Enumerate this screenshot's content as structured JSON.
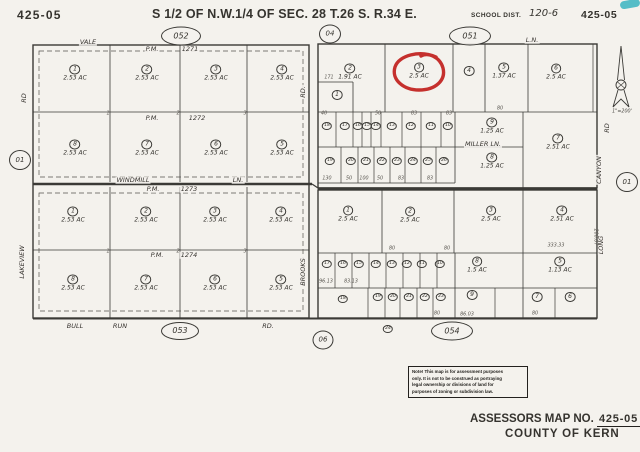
{
  "header": {
    "map_no_left": "425-05",
    "title": "S 1/2 OF N.W.1/4 OF SEC. 28 T.26 S. R.34 E.",
    "school_dist_label": "SCHOOL DIST.",
    "school_dist_value": "120-6",
    "map_no_right": "425-05"
  },
  "map": {
    "colors": {
      "red_annotation": "#c5302d",
      "teal_artifact": "#38b4c0",
      "ink": "#3b3a36"
    },
    "north_arrow": {
      "scale_text": "1\"=200'"
    },
    "red_annotation": {
      "around": "parcel 3 (2.5 AC), right-top block"
    },
    "ref_circles": [
      {
        "label": "052",
        "x": 181,
        "y": 36,
        "w": 38,
        "h": 17
      },
      {
        "label": "04",
        "x": 330,
        "y": 34,
        "w": 20,
        "h": 17
      },
      {
        "label": "051",
        "x": 470,
        "y": 36,
        "w": 40,
        "h": 17
      },
      {
        "label": "01",
        "x": 20,
        "y": 160,
        "w": 20,
        "h": 18
      },
      {
        "label": "01",
        "x": 627,
        "y": 182,
        "w": 20,
        "h": 18
      },
      {
        "label": "053",
        "x": 180,
        "y": 331,
        "w": 36,
        "h": 16
      },
      {
        "label": "06",
        "x": 323,
        "y": 340,
        "w": 19,
        "h": 17
      },
      {
        "label": "054",
        "x": 452,
        "y": 331,
        "w": 40,
        "h": 17
      }
    ],
    "street_labels": [
      {
        "t": "VALE",
        "x": 88,
        "y": 42
      },
      {
        "t": "P.M.",
        "x": 152,
        "y": 49
      },
      {
        "t": "1271",
        "x": 190,
        "y": 49
      },
      {
        "t": "P.M.",
        "x": 152,
        "y": 118
      },
      {
        "t": "1272",
        "x": 197,
        "y": 118
      },
      {
        "t": "WINDMILL",
        "x": 133,
        "y": 180
      },
      {
        "t": "LN.",
        "x": 238,
        "y": 180
      },
      {
        "t": "P.M.",
        "x": 153,
        "y": 189
      },
      {
        "t": "1273",
        "x": 189,
        "y": 189
      },
      {
        "t": "P.M.",
        "x": 157,
        "y": 255
      },
      {
        "t": "1274",
        "x": 189,
        "y": 255
      },
      {
        "t": "BULL",
        "x": 75,
        "y": 326
      },
      {
        "t": "RUN",
        "x": 120,
        "y": 326
      },
      {
        "t": "RD.",
        "x": 268,
        "y": 326
      },
      {
        "t": "MILLER LN.",
        "x": 483,
        "y": 144
      },
      {
        "t": "L.N.",
        "x": 532,
        "y": 40
      },
      {
        "t": "RD",
        "x": 24,
        "y": 98,
        "r": -90
      },
      {
        "t": "LAKEVIEW",
        "x": 22,
        "y": 262,
        "r": -90
      },
      {
        "t": "RD.",
        "x": 303,
        "y": 92,
        "r": -90
      },
      {
        "t": "BROOKS",
        "x": 303,
        "y": 272,
        "r": -90
      },
      {
        "t": "RD",
        "x": 607,
        "y": 128,
        "r": -90
      },
      {
        "t": "CANYON",
        "x": 599,
        "y": 170,
        "r": -90
      },
      {
        "t": "LONG",
        "x": 601,
        "y": 245,
        "r": -90
      }
    ],
    "parcels": [
      {
        "b": "lt",
        "n": "1",
        "ac": "2.53 AC",
        "x": 75,
        "y": 73
      },
      {
        "b": "lt",
        "n": "2",
        "ac": "2.53 AC",
        "x": 147,
        "y": 73
      },
      {
        "b": "lt",
        "n": "3",
        "ac": "2.53 AC",
        "x": 216,
        "y": 73
      },
      {
        "b": "lt",
        "n": "4",
        "ac": "2.53 AC",
        "x": 282,
        "y": 73
      },
      {
        "b": "lt",
        "n": "8",
        "ac": "2.53 AC",
        "x": 75,
        "y": 148
      },
      {
        "b": "lt",
        "n": "7",
        "ac": "2.53 AC",
        "x": 147,
        "y": 148
      },
      {
        "b": "lt",
        "n": "6",
        "ac": "2.53 AC",
        "x": 216,
        "y": 148
      },
      {
        "b": "lt",
        "n": "5",
        "ac": "2.53 AC",
        "x": 282,
        "y": 148
      },
      {
        "b": "lb",
        "n": "1",
        "ac": "2.53 AC",
        "x": 73,
        "y": 215
      },
      {
        "b": "lb",
        "n": "2",
        "ac": "2.53 AC",
        "x": 146,
        "y": 215
      },
      {
        "b": "lb",
        "n": "3",
        "ac": "2.53 AC",
        "x": 215,
        "y": 215
      },
      {
        "b": "lb",
        "n": "4",
        "ac": "2.53 AC",
        "x": 281,
        "y": 215
      },
      {
        "b": "lb",
        "n": "8",
        "ac": "2.53 AC",
        "x": 73,
        "y": 283
      },
      {
        "b": "lb",
        "n": "7",
        "ac": "2.53 AC",
        "x": 146,
        "y": 283
      },
      {
        "b": "lb",
        "n": "6",
        "ac": "2.53 AC",
        "x": 215,
        "y": 283
      },
      {
        "b": "lb",
        "n": "5",
        "ac": "2.53 AC",
        "x": 281,
        "y": 283
      },
      {
        "b": "rt",
        "n": "2",
        "ac": "1.91 AC",
        "x": 350,
        "y": 72
      },
      {
        "b": "rt",
        "n": "1",
        "x": 337,
        "y": 95
      },
      {
        "b": "rt",
        "n": "3",
        "ac": "2.5 AC",
        "x": 419,
        "y": 71
      },
      {
        "b": "rt",
        "n": "4",
        "x": 469,
        "y": 71
      },
      {
        "b": "rt",
        "n": "5",
        "ac": "1.37 AC",
        "x": 504,
        "y": 71
      },
      {
        "b": "rt",
        "n": "6",
        "ac": "2.5 AC",
        "x": 556,
        "y": 72
      },
      {
        "b": "rt",
        "n": "18",
        "s": "t",
        "x": 327,
        "y": 126
      },
      {
        "b": "rt",
        "n": "17",
        "s": "t",
        "x": 345,
        "y": 126
      },
      {
        "b": "rt",
        "n": "16",
        "s": "t",
        "x": 358,
        "y": 126
      },
      {
        "b": "rt",
        "n": "15",
        "s": "t",
        "x": 367,
        "y": 126
      },
      {
        "b": "rt",
        "n": "14",
        "s": "t",
        "x": 376,
        "y": 126
      },
      {
        "b": "rt",
        "n": "13",
        "s": "t",
        "x": 392,
        "y": 126
      },
      {
        "b": "rt",
        "n": "12",
        "s": "t",
        "x": 411,
        "y": 126
      },
      {
        "b": "rt",
        "n": "11",
        "s": "t",
        "x": 431,
        "y": 126
      },
      {
        "b": "rt",
        "n": "10",
        "s": "t",
        "x": 448,
        "y": 126
      },
      {
        "b": "rt",
        "n": "9",
        "ac": "1.25 AC",
        "x": 492,
        "y": 126
      },
      {
        "b": "rt",
        "n": "19",
        "s": "t",
        "x": 330,
        "y": 161
      },
      {
        "b": "rt",
        "n": "20",
        "s": "t",
        "x": 351,
        "y": 161
      },
      {
        "b": "rt",
        "n": "21",
        "s": "t",
        "x": 366,
        "y": 161
      },
      {
        "b": "rt",
        "n": "22",
        "s": "t",
        "x": 382,
        "y": 161
      },
      {
        "b": "rt",
        "n": "23",
        "s": "t",
        "x": 397,
        "y": 161
      },
      {
        "b": "rt",
        "n": "24",
        "s": "t",
        "x": 413,
        "y": 161
      },
      {
        "b": "rt",
        "n": "25",
        "s": "t",
        "x": 428,
        "y": 161
      },
      {
        "b": "rt",
        "n": "26",
        "s": "t",
        "x": 444,
        "y": 161
      },
      {
        "b": "rt",
        "n": "8",
        "ac": "1.25 AC",
        "x": 492,
        "y": 161
      },
      {
        "b": "rt",
        "n": "7",
        "ac": "2.51 AC",
        "x": 558,
        "y": 142
      },
      {
        "b": "rb",
        "n": "1",
        "ac": "2.5 AC",
        "x": 348,
        "y": 214
      },
      {
        "b": "rb",
        "n": "2",
        "ac": "2.5 AC",
        "x": 410,
        "y": 215
      },
      {
        "b": "rb",
        "n": "3",
        "ac": "2.5 AC",
        "x": 491,
        "y": 214
      },
      {
        "b": "rb",
        "n": "4",
        "ac": "2.51 AC",
        "x": 562,
        "y": 214
      },
      {
        "b": "rb",
        "n": "17",
        "s": "t",
        "x": 327,
        "y": 264
      },
      {
        "b": "rb",
        "n": "16",
        "s": "t",
        "x": 343,
        "y": 264
      },
      {
        "b": "rb",
        "n": "15",
        "s": "t",
        "x": 359,
        "y": 264
      },
      {
        "b": "rb",
        "n": "14",
        "s": "t",
        "x": 376,
        "y": 264
      },
      {
        "b": "rb",
        "n": "13",
        "s": "t",
        "x": 392,
        "y": 264
      },
      {
        "b": "rb",
        "n": "12",
        "s": "t",
        "x": 407,
        "y": 264
      },
      {
        "b": "rb",
        "n": "11",
        "s": "t",
        "x": 422,
        "y": 264
      },
      {
        "b": "rb",
        "n": "10",
        "s": "t",
        "x": 440,
        "y": 264
      },
      {
        "b": "rb",
        "n": "8",
        "ac": "1.5 AC",
        "x": 477,
        "y": 265
      },
      {
        "b": "rb",
        "n": "5",
        "ac": "1.13 AC",
        "x": 560,
        "y": 265
      },
      {
        "b": "rb",
        "n": "18",
        "s": "t",
        "x": 343,
        "y": 299
      },
      {
        "b": "rb",
        "n": "19",
        "s": "t",
        "x": 378,
        "y": 297
      },
      {
        "b": "rb",
        "n": "20",
        "s": "t",
        "x": 393,
        "y": 297
      },
      {
        "b": "rb",
        "n": "21",
        "s": "t",
        "x": 409,
        "y": 297
      },
      {
        "b": "rb",
        "n": "22",
        "s": "t",
        "x": 425,
        "y": 297
      },
      {
        "b": "rb",
        "n": "23",
        "s": "t",
        "x": 441,
        "y": 297
      },
      {
        "b": "rb",
        "n": "9",
        "x": 472,
        "y": 295
      },
      {
        "b": "rb",
        "n": "7",
        "x": 537,
        "y": 297
      },
      {
        "b": "rb",
        "n": "6",
        "x": 570,
        "y": 297
      },
      {
        "b": "rb",
        "n": "24",
        "s": "t",
        "x": 388,
        "y": 329
      }
    ],
    "dimensions": [
      {
        "t": "171",
        "x": 329,
        "y": 79
      },
      {
        "t": "40",
        "x": 324,
        "y": 115
      },
      {
        "t": "50",
        "x": 378,
        "y": 115
      },
      {
        "t": "83",
        "x": 414,
        "y": 115
      },
      {
        "t": "83",
        "x": 449,
        "y": 115
      },
      {
        "t": "80",
        "x": 500,
        "y": 110
      },
      {
        "t": "130",
        "x": 327,
        "y": 180
      },
      {
        "t": "50",
        "x": 349,
        "y": 180
      },
      {
        "t": "100",
        "x": 364,
        "y": 180
      },
      {
        "t": "50",
        "x": 380,
        "y": 180
      },
      {
        "t": "83",
        "x": 401,
        "y": 180
      },
      {
        "t": "83",
        "x": 430,
        "y": 180
      },
      {
        "t": "1",
        "x": 108,
        "y": 115
      },
      {
        "t": "2",
        "x": 178,
        "y": 115
      },
      {
        "t": "3",
        "x": 245,
        "y": 115
      },
      {
        "t": "1",
        "x": 108,
        "y": 253
      },
      {
        "t": "2",
        "x": 178,
        "y": 253
      },
      {
        "t": "3",
        "x": 245,
        "y": 253
      },
      {
        "t": "80",
        "x": 392,
        "y": 250
      },
      {
        "t": "80",
        "x": 447,
        "y": 250
      },
      {
        "t": "333.33",
        "x": 556,
        "y": 247
      },
      {
        "t": "200.07",
        "x": 594,
        "y": 237,
        "r": 90
      },
      {
        "t": "96.13",
        "x": 326,
        "y": 283
      },
      {
        "t": "83.13",
        "x": 351,
        "y": 283
      },
      {
        "t": "86.03",
        "x": 467,
        "y": 316
      },
      {
        "t": "80",
        "x": 437,
        "y": 315
      },
      {
        "t": "80",
        "x": 535,
        "y": 315
      }
    ]
  },
  "note_box": {
    "lines": [
      "Note! This map is for assessment purposes",
      "only. It is not to be construed as portraying",
      "legal ownership or divisions of land for",
      "purposes of zoning or subdivision law."
    ]
  },
  "footer": {
    "assessors_label": "ASSESSORS MAP NO.",
    "map_no": "425-05",
    "county": "COUNTY OF KERN"
  }
}
